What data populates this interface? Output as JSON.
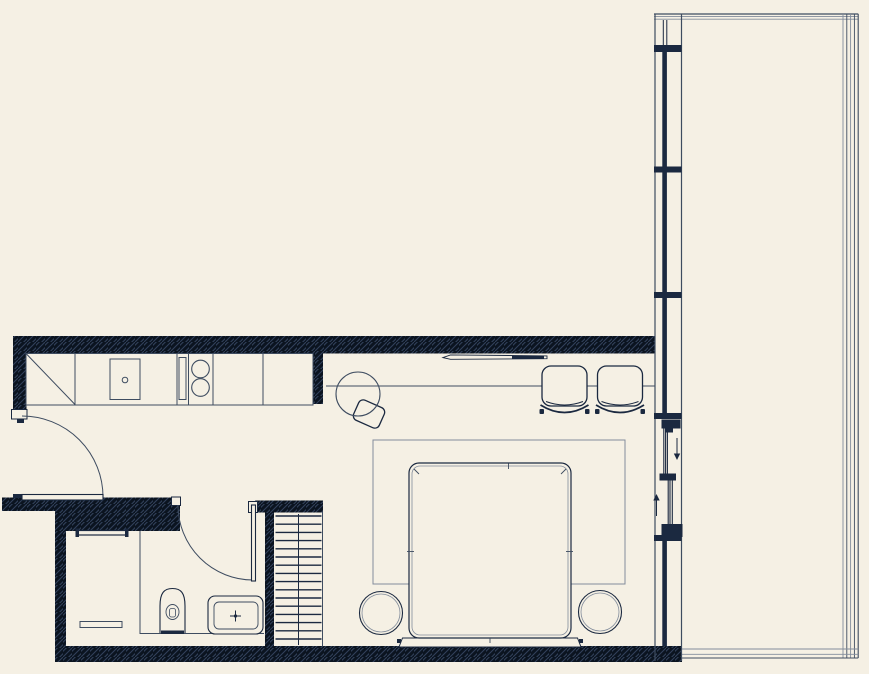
{
  "canvas": {
    "width_px": 869,
    "height_px": 674,
    "background": "#f5f0e4"
  },
  "palette": {
    "background": "#f5f0e4",
    "wall_fill": "#0b1420",
    "wall_hatch": "#33425c",
    "ink": "#1b2940",
    "line_mid": "#3e4c60",
    "line_light": "#828c9b",
    "furniture_fill": "#f5f0e4"
  },
  "plan": {
    "type": "studio-apartment-floor-plan",
    "rooms": [
      "entry",
      "kitchen",
      "living-dining",
      "bedroom-area",
      "bathroom",
      "staircase",
      "terrace"
    ],
    "fixtures": {
      "cooktop_burners": 2,
      "lounge_chairs": 2,
      "bed_side_tables": 2,
      "stair_treads": 16,
      "terrace_railing_lines_top": 3,
      "terrace_railing_lines_right": 5,
      "terrace_railing_lines_bottom": 3,
      "sliding_door_panels": 2,
      "window_mullion_crossbars": 5,
      "swing_doors": 2
    }
  }
}
